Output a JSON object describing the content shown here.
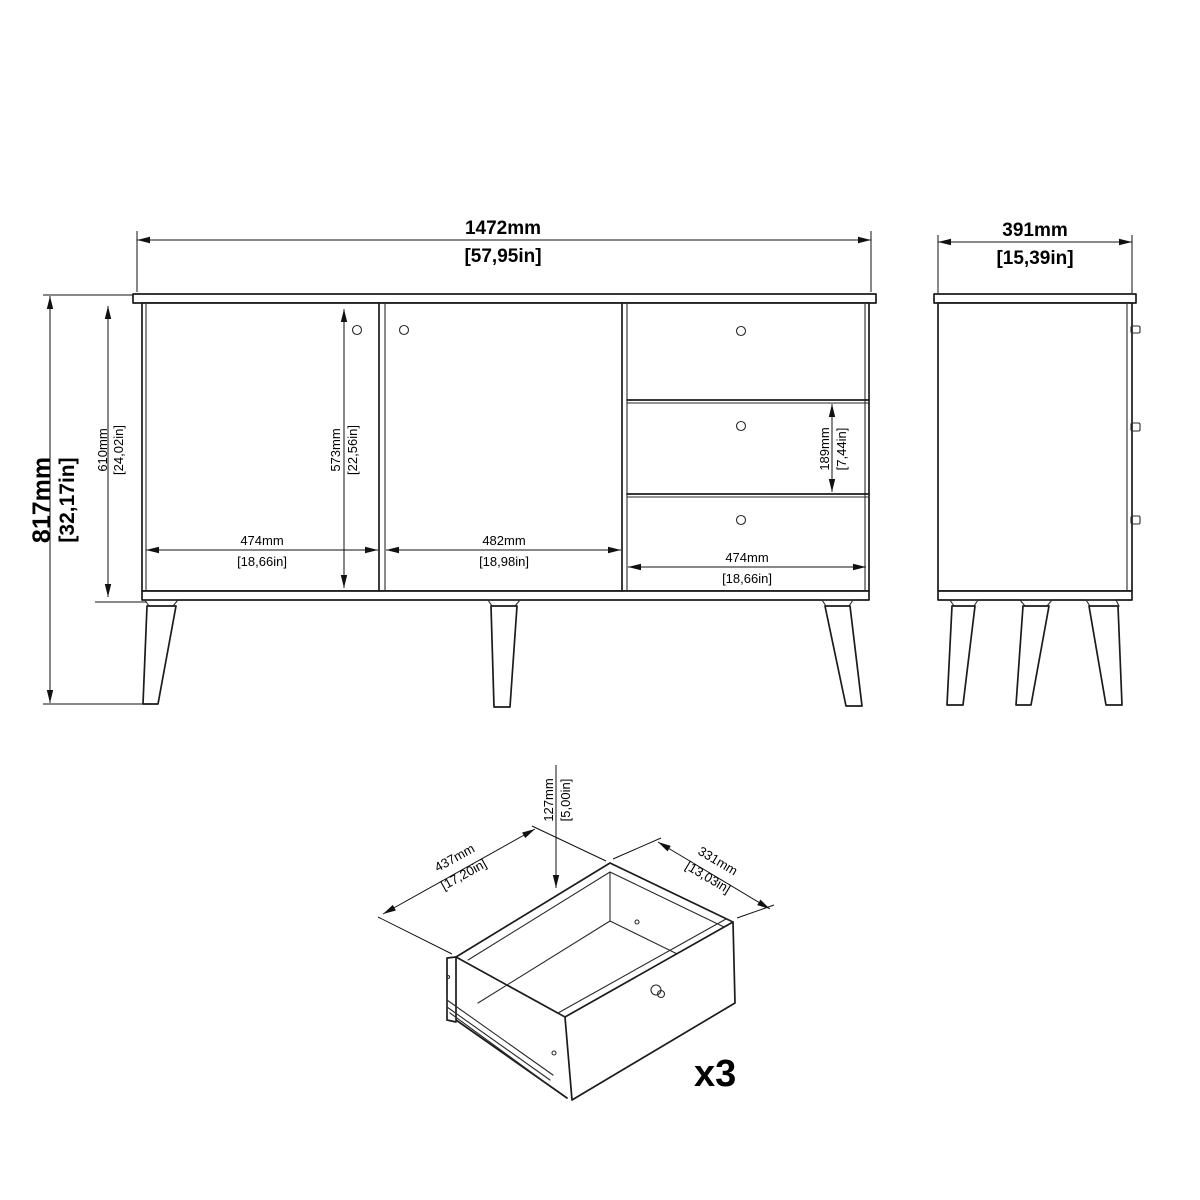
{
  "front": {
    "overall_width_mm": "1472mm",
    "overall_width_in": "[57,95in]",
    "overall_height_mm": "817mm",
    "overall_height_in": "[32,17in]",
    "carcass_height_mm": "610mm",
    "carcass_height_in": "[24,02in]",
    "door_height_mm": "573mm",
    "door_height_in": "[22,56in]",
    "left_door_width_mm": "474mm",
    "left_door_width_in": "[18,66in]",
    "middle_door_width_mm": "482mm",
    "middle_door_width_in": "[18,98in]",
    "drawer_width_mm": "474mm",
    "drawer_width_in": "[18,66in]",
    "drawer_front_height_mm": "189mm",
    "drawer_front_height_in": "[7,44in]"
  },
  "side": {
    "depth_mm": "391mm",
    "depth_in": "[15,39in]"
  },
  "drawer": {
    "box_height_mm": "127mm",
    "box_height_in": "[5,00in]",
    "box_width_mm": "437mm",
    "box_width_in": "[17,20in]",
    "box_depth_mm": "331mm",
    "box_depth_in": "[13,03in]",
    "quantity_label": "x3"
  }
}
